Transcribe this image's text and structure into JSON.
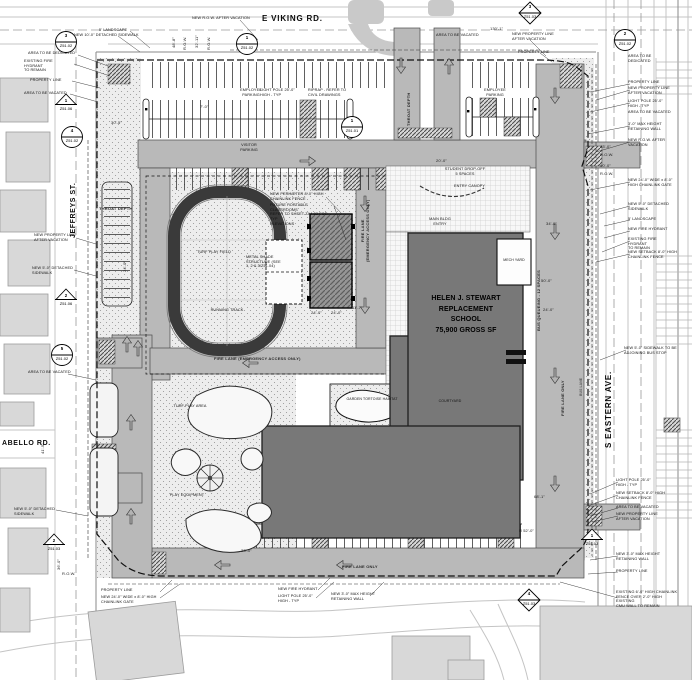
{
  "colors": {
    "drive": "#b9b9b9",
    "building": "#787878",
    "track_ring": "#3a3a3a",
    "property_line": "#101010",
    "context": "#c4c4c4"
  },
  "streets": {
    "viking": "E VIKING RD.",
    "jeffreys": "JEFFREYS ST.",
    "eastern": "S EASTERN AVE.",
    "abello": "ABELLO RD."
  },
  "building": {
    "name": "HELEN J. STEWART\nREPLACEMENT\nSCHOOL\n75,900 GROSS SF",
    "mech_yard": "MECH YARD",
    "courtyard": "COURTYARD",
    "garden": "GARDEN TORTOISE HABITAT"
  },
  "lanes": [
    "FIRE LANE ONLY",
    "FIRE LANE ONLY",
    "FIRE LANE\n(EMERGENCY ACCESS ONLY)",
    "FIRE LANE (EMERGENCY ACCESS ONLY)",
    "BUS QUEUEING - 12 SPACES",
    "THROAT DEPTH",
    "THROAT DEPTH",
    "BUS LANE"
  ],
  "notes": [
    "NEW R.O.W. AFTER VACATION",
    "5' LANDSCAPE",
    "NEW 10'-0\" DETACHED SIDEWALK",
    "AREA TO BE DEDICATED",
    "EXISTING FIRE HYDRANT\nTO REMAIN",
    "PROPERTY LINE",
    "AREA TO BE VACATED",
    "EMPLOYEE\nPARKING",
    "LIGHT POLE 25'-0\"\nHIGH - TYP",
    "RIPRAP - REFER TO\nCIVIL DRAWINGS",
    "VISITOR\nPARKING",
    "EMPLOYEE\nPARKING",
    "AREA TO BE VACATED",
    "NEW PROPERTY LINE\nAFTER VACATION",
    "PROPERTY LINE",
    "AREA TO BE\nDEDICATED",
    "PROPERTY LINE",
    "NEW PROPERTY LINE\nAFTER VACATION",
    "LIGHT POLE 25'-0\"\nHIGH - TYP",
    "AREA TO BE VACATED",
    "3'-0\" MAX HEIGHT\nRETAINING WALL",
    "NEW R.O.W. AFTER\nVACATION",
    "NEW 24'-0\" WIDE x 8'-0\"\nHIGH CHAINLINK GATE",
    "NEW 5'-0\" DETACHED\nSIDEWALK",
    "5' LANDSCAPE",
    "NEW FIRE HYDRANT",
    "EXISTING FIRE HYDRANT\nTO REMAIN",
    "NEW SETBACK 8'-0\" HIGH\nCHAINLINK FENCE",
    "NEW 5'-0\" SIDEWALK TO BE\nADJOINING BUS STOP",
    "LIGHT POLE 25'-0\"\nHIGH - TYP",
    "NEW SETBACK 8'-0\" HIGH\nCHAINLINK FENCE",
    "AREA TO BE VACATED",
    "NEW PROPERTY LINE\nAFTER VACATION",
    "NEW 3'-0\" MAX HEIGHT\nRETAINING WALL",
    "PROPERTY LINE",
    "EXISTING 6'-0\" HIGH CHAINLINK\nFENCE OVER 2'-0\" HIGH EXISTING\nCMU WALL TO REMAIN",
    "PROPERTY LINE",
    "NEW 24'-0\" WIDE x 8'-0\" HIGH\nCHAINLINK GATE",
    "NEW FIRE HYDRANT",
    "LIGHT POLE 25'-0\"\nHIGH - TYP",
    "NEW 3'-0\" MAX HEIGHT\nRETAINING WALL",
    "NEW PERIMETER 8'-0\" HIGH\nCHAINLINK FENCE",
    "FUTURE PORTABLE CLASSROOMS\nREFER TO SHEET ZA4.03 FOR TYP\nELEVATIONS",
    "METAL SHADE\nSTRUCTURE (SEE\n1, 2 & 3/Z51.04)",
    "STUDENT DROP-OFF\n5 SPACES",
    "ENTRY CANOPY",
    "MAIN BLDG\nENTRY",
    "NEW PROPERTY LINE\nAFTER VACATION",
    "NEW 5'-0\" DETACHED\nSIDEWALK",
    "AREA TO BE VACATED",
    "NEW 5'-0\" DETACHED\nSIDEWALK",
    "TURF PLAY FIELD",
    "RUNNING TRACK",
    "TURF PLAY AREA",
    "PLAY EQUIPMENT"
  ],
  "dims": [
    "48'-8\"",
    "R.O.W.",
    "32'-11\"",
    "R.O.W.",
    "130'-1\"",
    "43'-0\"",
    "R.O.W.",
    "50'-0\"",
    "R.O.W.",
    "30'-5\"",
    "7'-0\"",
    "24'-0\"",
    "24'-0\"",
    "11'-7\"",
    "34'-0\"",
    "50'-0\"",
    "24'-0\"",
    "68'-1\"",
    "R 52'-0\"",
    "20'-0\"",
    "23'-0\"",
    "R.O.W.",
    "36'-0\"",
    "24'-0\"",
    "41'-5\""
  ],
  "callouts": [
    {
      "n": "3",
      "s": "Z51.02"
    },
    {
      "n": "1",
      "s": "Z51.06"
    },
    {
      "n": "1",
      "s": "Z51.02"
    },
    {
      "n": "3",
      "s": "Z51.03"
    },
    {
      "n": "2",
      "s": "Z51.02"
    },
    {
      "n": "1",
      "s": "Z51.01"
    },
    {
      "n": "4",
      "s": "Z51.02"
    },
    {
      "n": "2",
      "s": "Z51.06"
    },
    {
      "n": "5",
      "s": "Z51.02"
    },
    {
      "n": "2",
      "s": "Z51.03"
    },
    {
      "n": "1",
      "s": "Z51.03"
    },
    {
      "n": "4",
      "s": "Z51.03"
    }
  ]
}
